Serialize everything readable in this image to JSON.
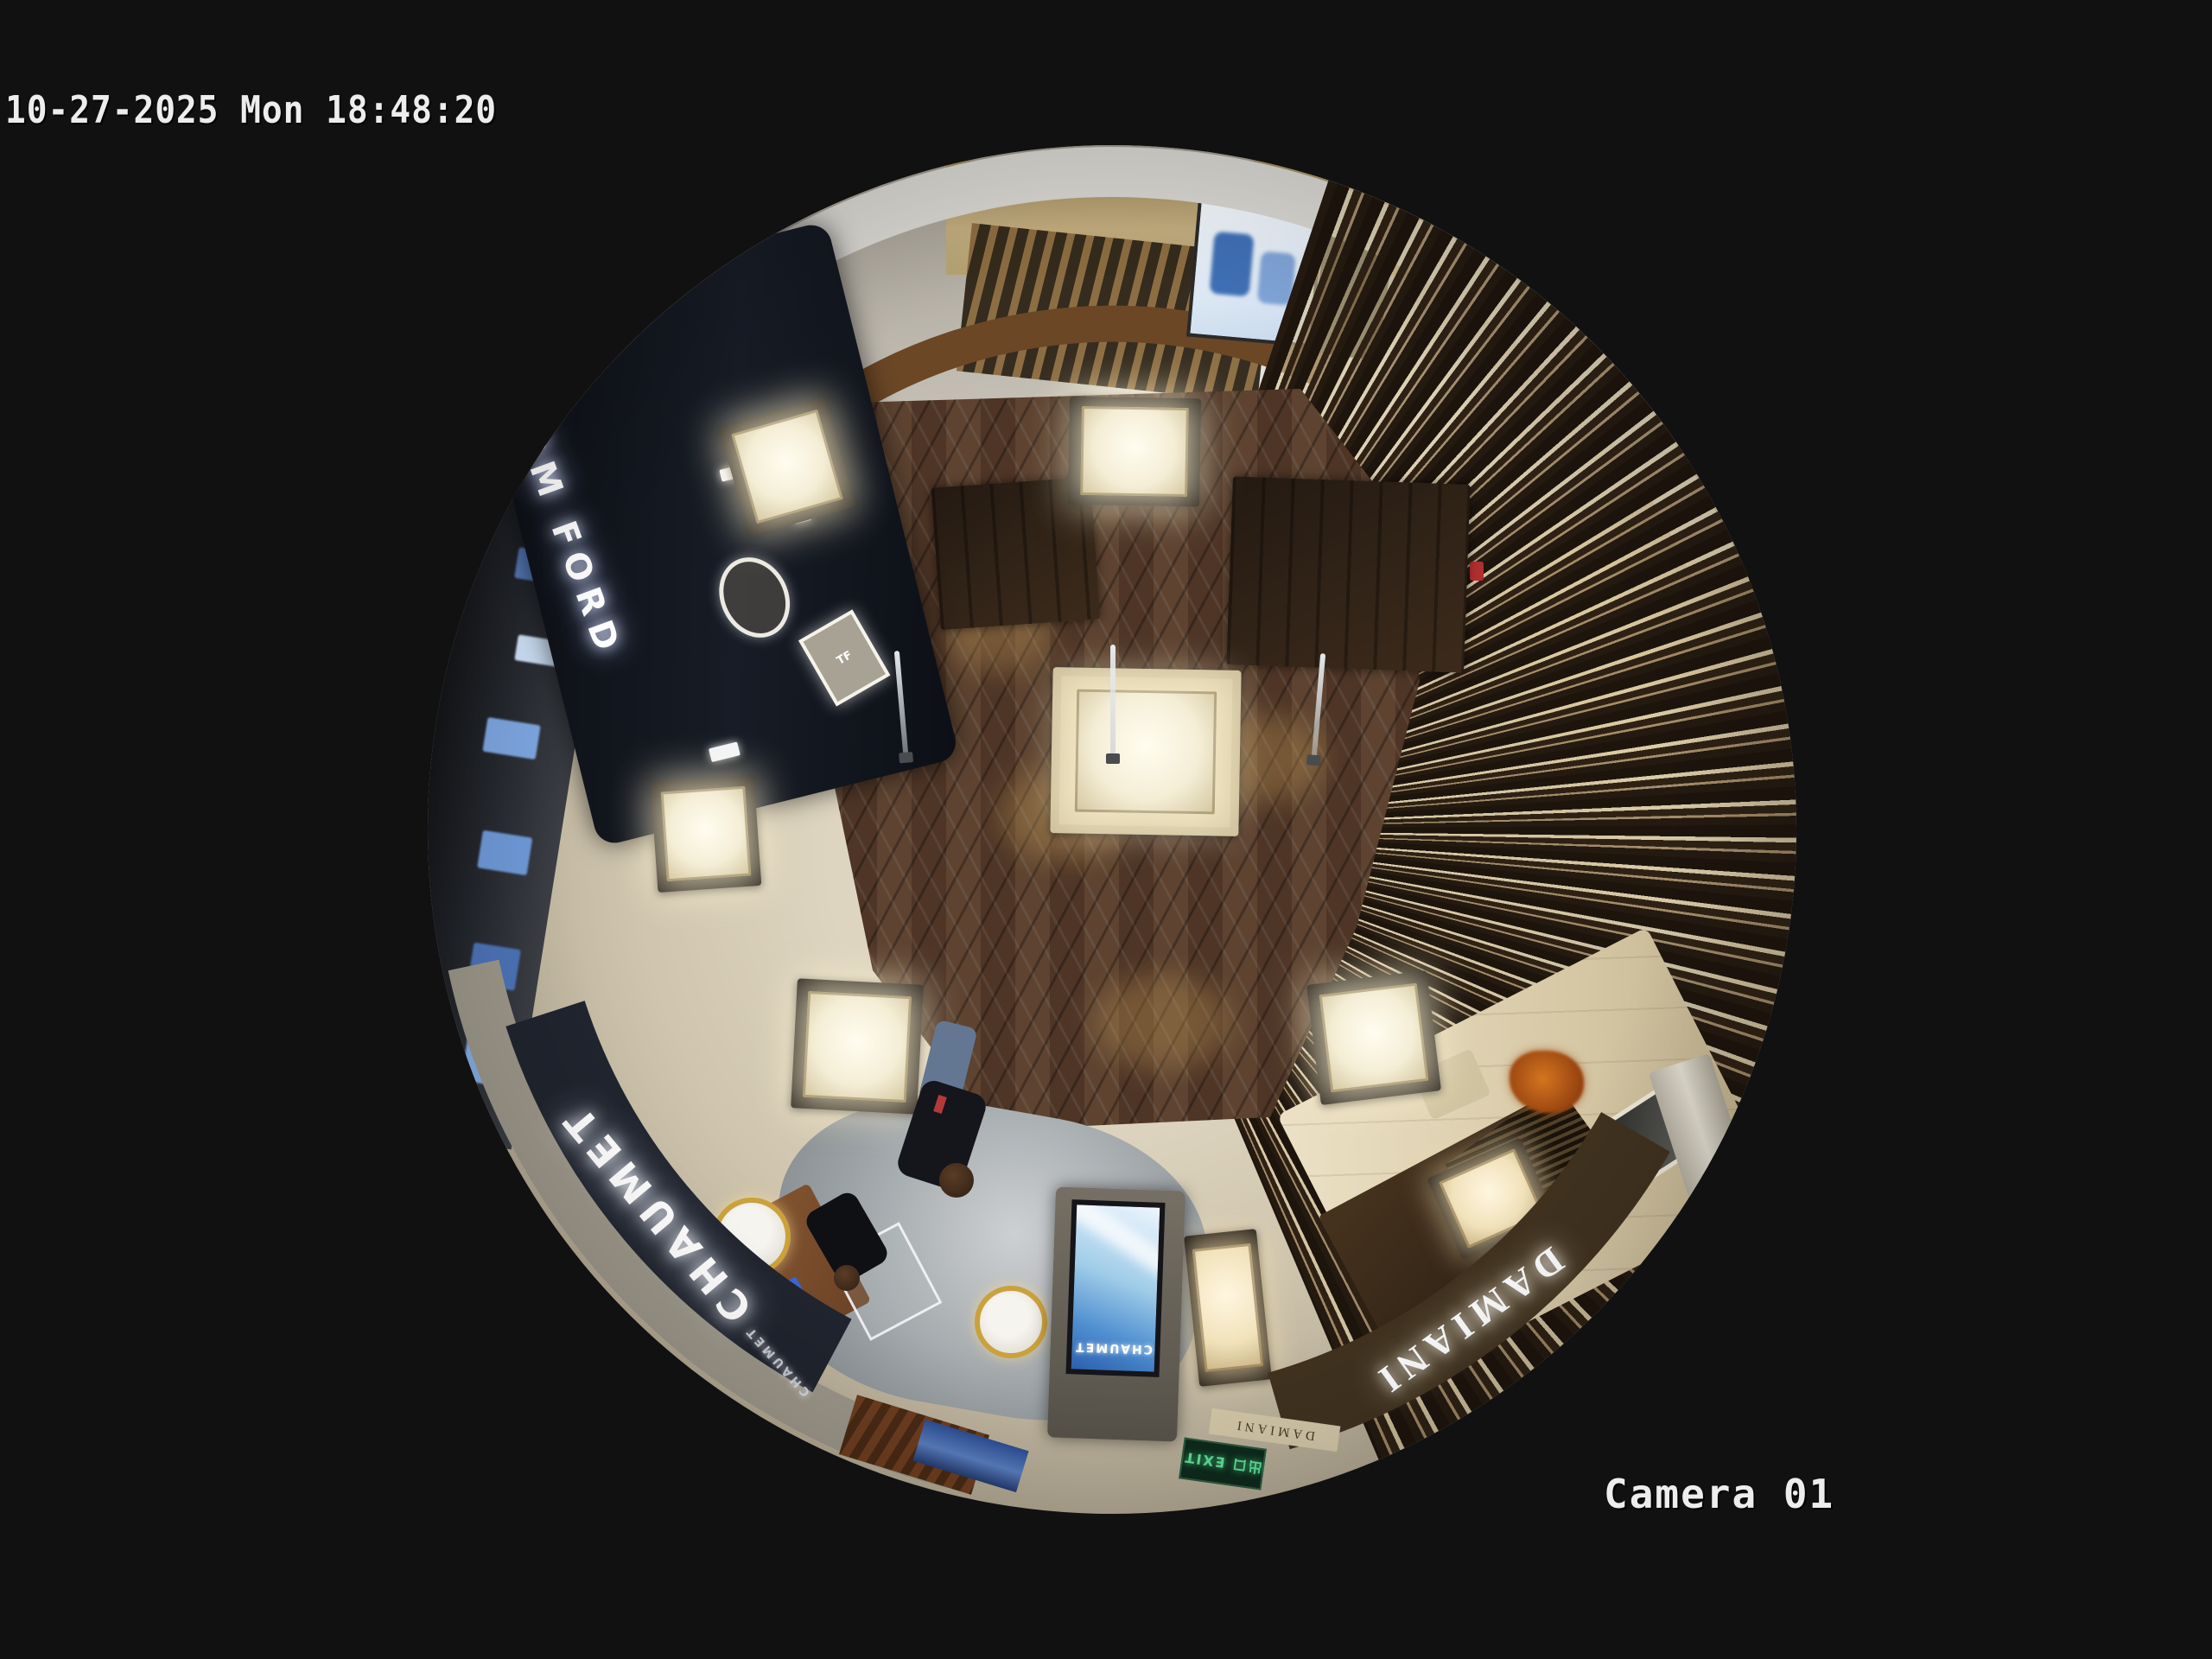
{
  "osd": {
    "timestamp": "10-27-2025 Mon 18:48:20",
    "camera_label": "Camera 01",
    "text_color": "#ededed"
  },
  "scene": {
    "description": "Fisheye overhead camera view of a luxury jewelry retail floor",
    "signs": {
      "tom_ford": "TOM FORD",
      "tf_monogram": "TF",
      "chaumet_fascia": "CHAUMET",
      "chaumet_small": "CHAUMET",
      "chaumet_kiosk_screen": "CHAUMET",
      "damiani_fascia": "DAMIANI",
      "damiani_small": "DAMIANI",
      "exit_sign": "出口 EXIT"
    },
    "palette": {
      "background": "#111111",
      "wood_floor": "#553b2b",
      "stone_floor": "#cfc5ae",
      "marble_mall": "#c4bfb4",
      "ceiling_rim": "#d9d7d2",
      "chaumet_fascia_bg": "#20242e",
      "damiani_fascia_bg": "#40321f",
      "kiosk_screen_blue": "#4f8fd0",
      "exit_green": "#5fe09a",
      "case_glow": "#fff4d2",
      "counter_glow": "#f2a844"
    }
  }
}
